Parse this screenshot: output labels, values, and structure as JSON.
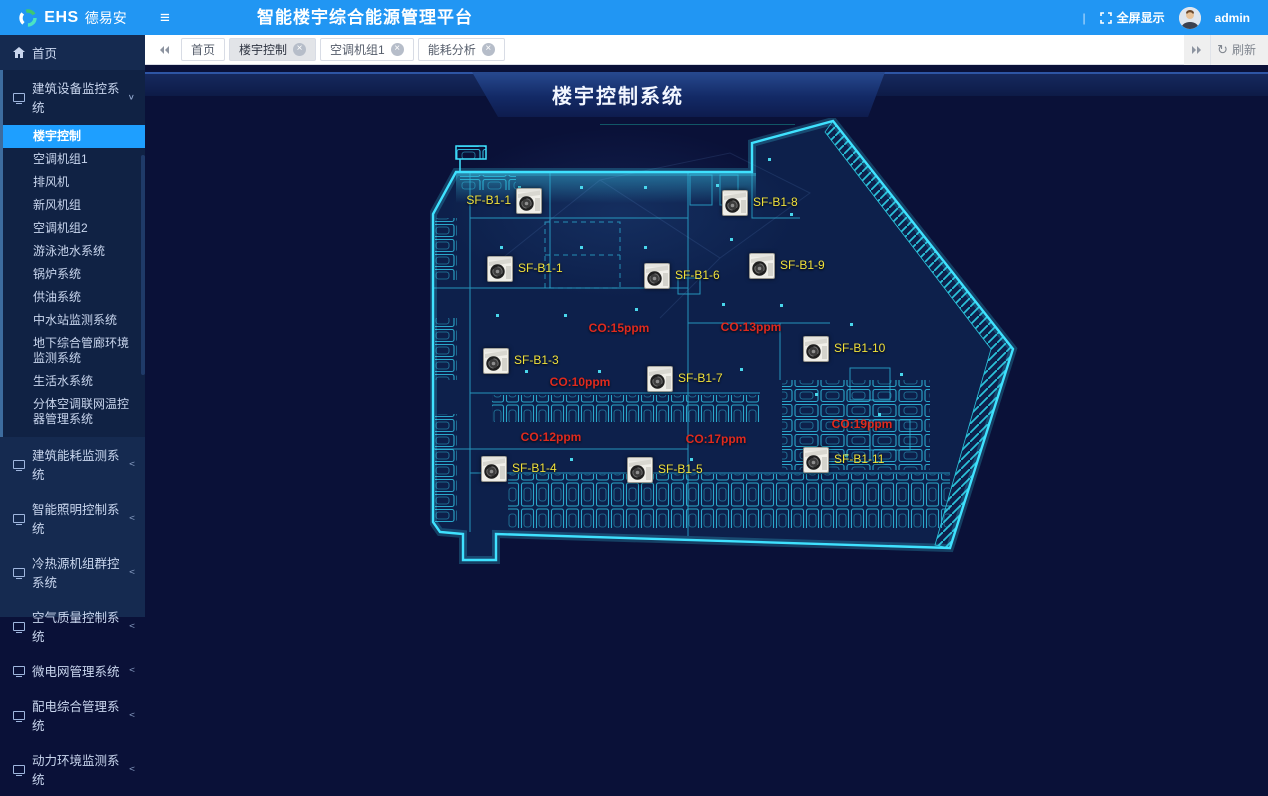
{
  "header": {
    "brand": "EHS",
    "brand_cn": "德易安",
    "title": "智能楼宇综合能源管理平台",
    "divider": "|",
    "fullscreen_label": "全屏显示",
    "username": "admin"
  },
  "icons": {
    "hamburger": "≡",
    "close": "×",
    "arrow_expanded": "∨",
    "arrow_collapsed": "<",
    "refresh": "↻"
  },
  "tabbar": {
    "tabs": [
      {
        "label": "首页",
        "closable": false,
        "active": false
      },
      {
        "label": "楼宇控制",
        "closable": true,
        "active": true
      },
      {
        "label": "空调机组1",
        "closable": true,
        "active": false
      },
      {
        "label": "能耗分析",
        "closable": true,
        "active": false
      }
    ],
    "refresh_label": "刷新"
  },
  "sidebar": {
    "home_label": "首页",
    "groups": [
      {
        "label": "建筑设备监控系统",
        "expanded": true,
        "active_child": "楼宇控制",
        "children": [
          "楼宇控制",
          "空调机组1",
          "排风机",
          "新风机组",
          "空调机组2",
          "游泳池水系统",
          "锅炉系统",
          "供油系统",
          "中水站监测系统",
          "地下综合管廊环境监测系统",
          "生活水系统",
          "分体空调联网温控器管理系统"
        ]
      },
      {
        "label": "建筑能耗监测系统",
        "expanded": false,
        "children": []
      },
      {
        "label": "智能照明控制系统",
        "expanded": false,
        "children": []
      },
      {
        "label": "冷热源机组群控系统",
        "expanded": false,
        "children": []
      },
      {
        "label": "空气质量控制系统",
        "expanded": false,
        "children": []
      },
      {
        "label": "微电网管理系统",
        "expanded": false,
        "children": []
      },
      {
        "label": "配电综合管理系统",
        "expanded": false,
        "children": []
      },
      {
        "label": "动力环境监测系统",
        "expanded": false,
        "children": []
      }
    ]
  },
  "main": {
    "banner_title": "楼宇控制系统",
    "floorplan": {
      "fans": [
        {
          "label": "SF-B1-1",
          "x": 99,
          "y": 82,
          "side": "left"
        },
        {
          "label": "SF-B1-8",
          "x": 305,
          "y": 84,
          "side": "right"
        },
        {
          "label": "SF-B1-1",
          "x": 70,
          "y": 150,
          "side": "right"
        },
        {
          "label": "SF-B1-6",
          "x": 227,
          "y": 157,
          "side": "right"
        },
        {
          "label": "SF-B1-9",
          "x": 332,
          "y": 147,
          "side": "right"
        },
        {
          "label": "SF-B1-10",
          "x": 386,
          "y": 230,
          "side": "right"
        },
        {
          "label": "SF-B1-3",
          "x": 66,
          "y": 242,
          "side": "right"
        },
        {
          "label": "SF-B1-7",
          "x": 230,
          "y": 260,
          "side": "right"
        },
        {
          "label": "SF-B1-4",
          "x": 64,
          "y": 350,
          "side": "right"
        },
        {
          "label": "SF-B1-5",
          "x": 210,
          "y": 351,
          "side": "right"
        },
        {
          "label": "SF-B1-11",
          "x": 386,
          "y": 341,
          "side": "right"
        }
      ],
      "co_readings": [
        {
          "text": "CO:15ppm",
          "x": 189,
          "y": 210
        },
        {
          "text": "CO:13ppm",
          "x": 321,
          "y": 209
        },
        {
          "text": "CO:10ppm",
          "x": 150,
          "y": 264
        },
        {
          "text": "CO:12ppm",
          "x": 121,
          "y": 319
        },
        {
          "text": "CO:17ppm",
          "x": 286,
          "y": 321
        },
        {
          "text": "CO:19ppm",
          "x": 432,
          "y": 306
        }
      ]
    }
  },
  "colors": {
    "header_blue": "#2196f3",
    "active_item": "#1e9fff",
    "sidebar_bg": "#152a50",
    "content_bg": "#0a1138",
    "plan_cyan": "#3fe2ff",
    "fan_label_yellow": "#f0e13c",
    "co_red": "#e02a1e"
  }
}
